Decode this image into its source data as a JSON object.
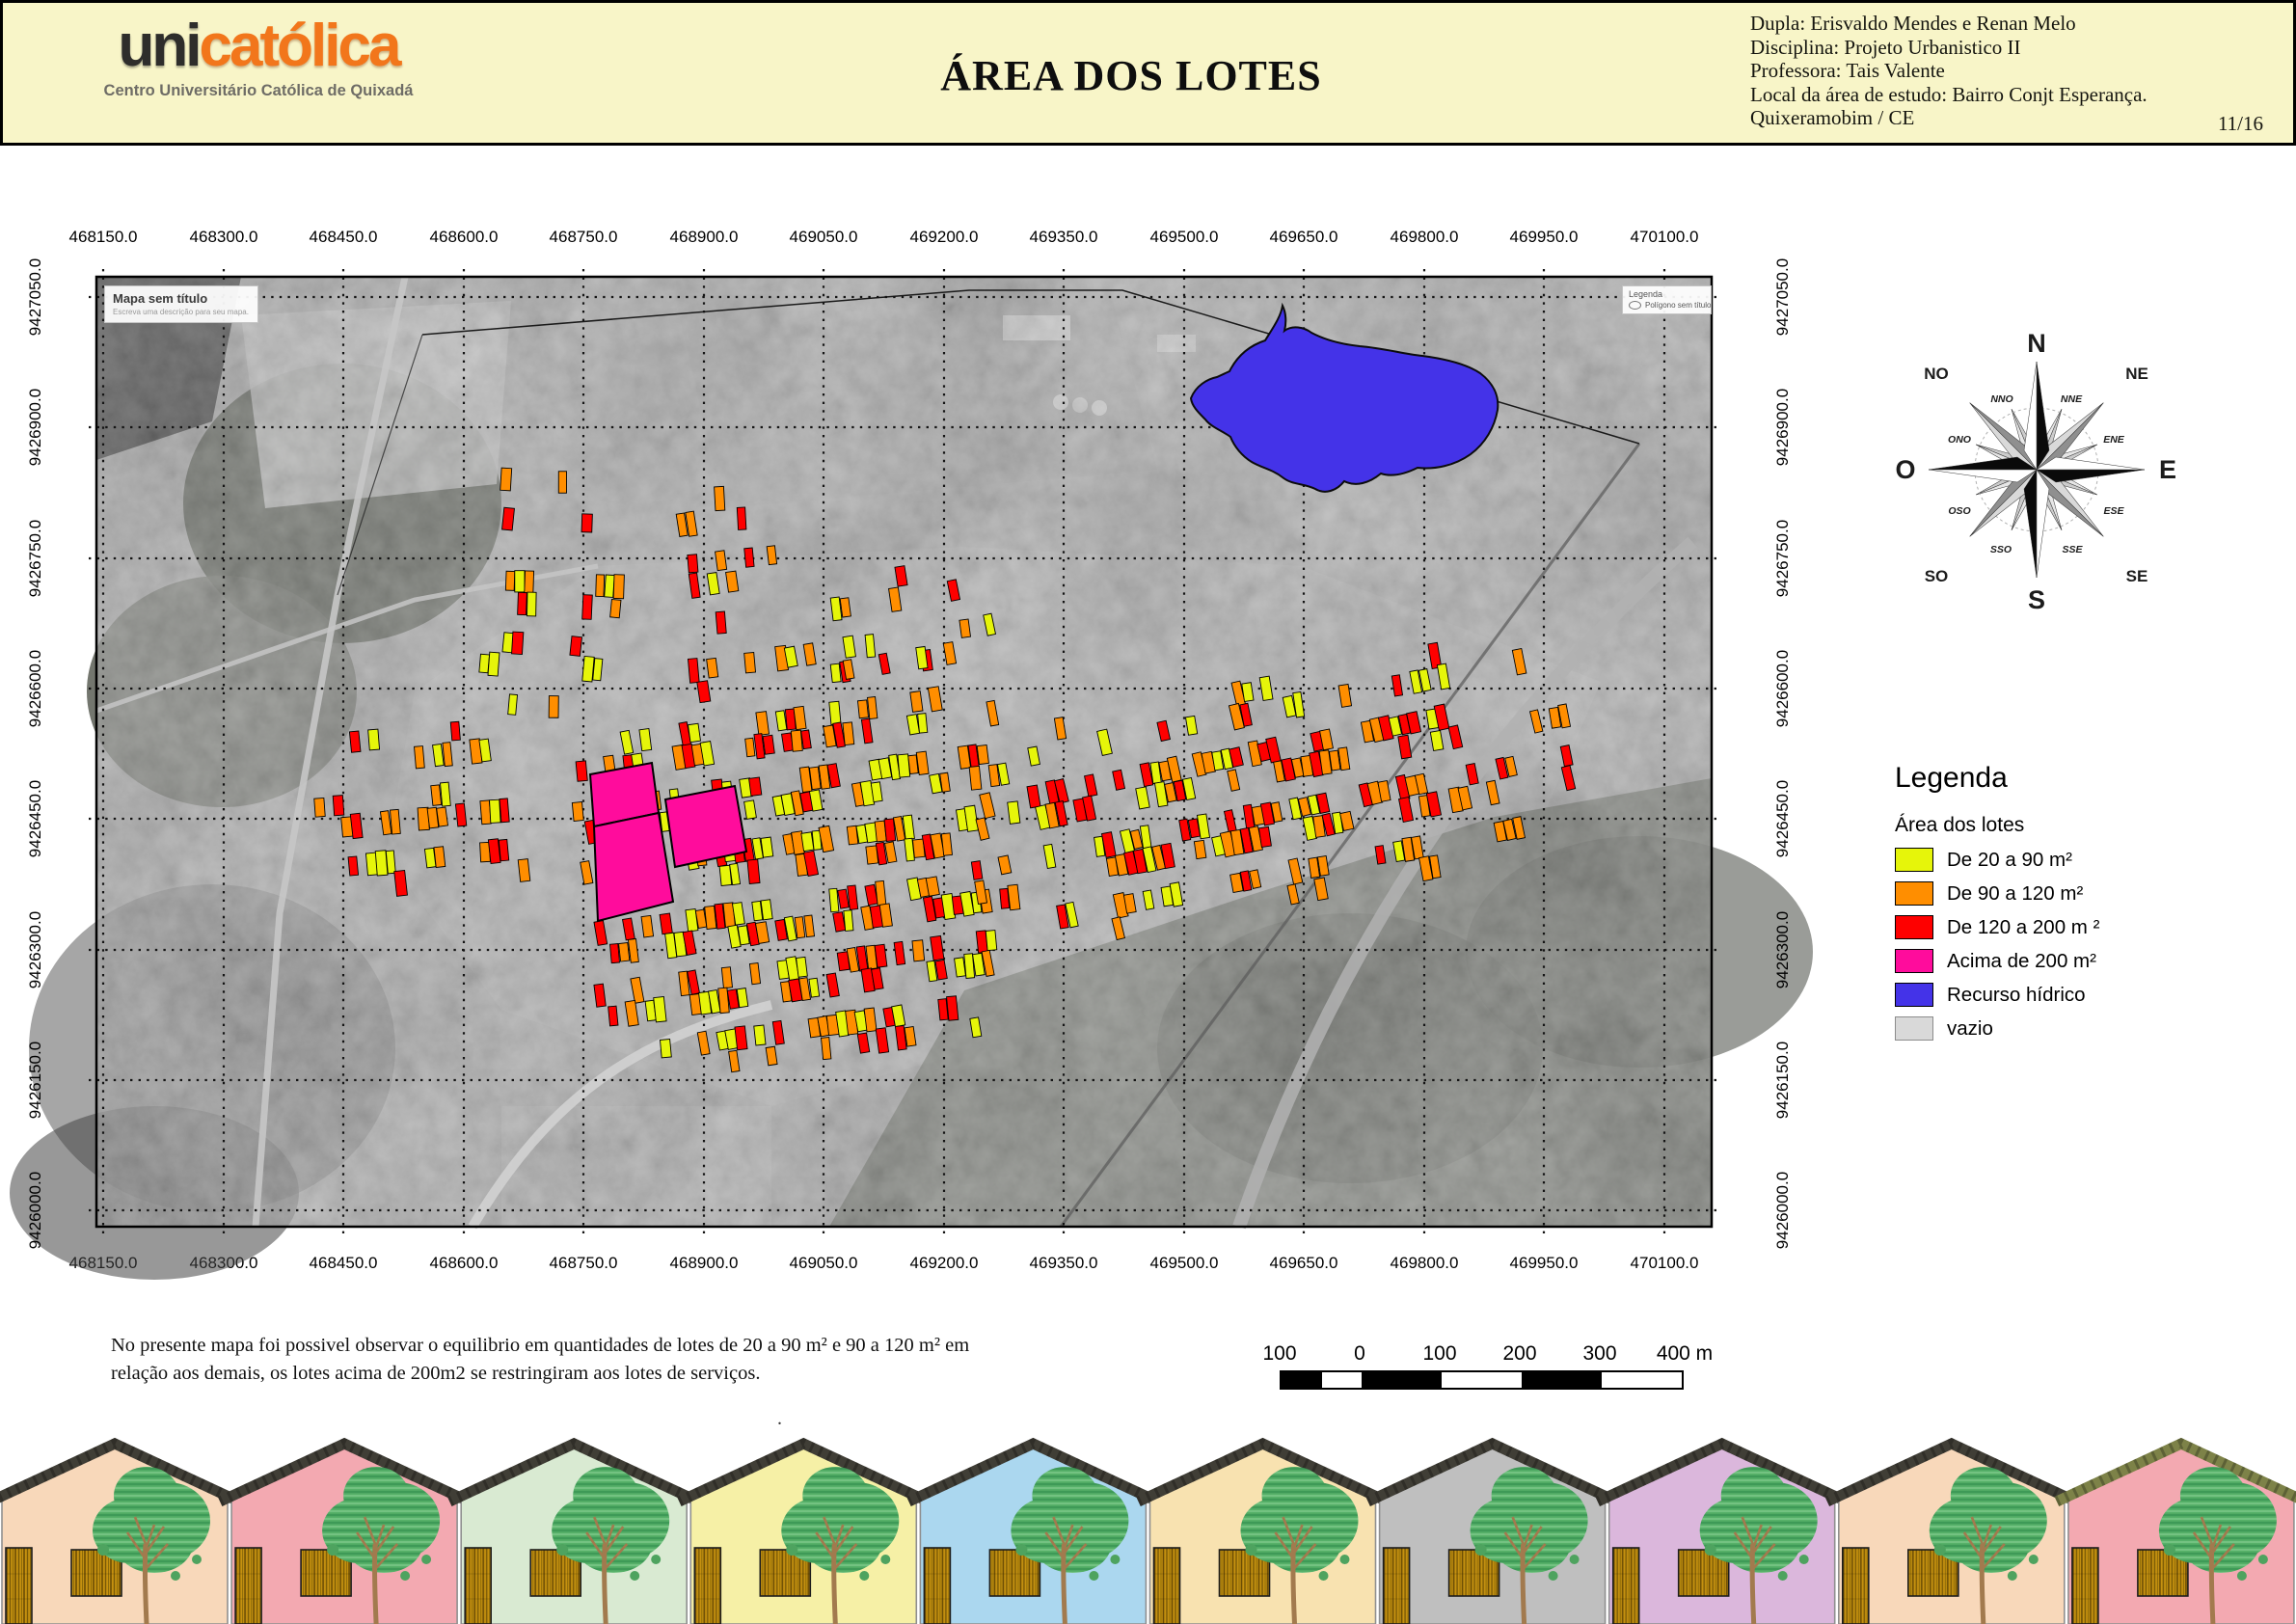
{
  "header": {
    "logo": {
      "part1": "uni",
      "part2": "católica",
      "subtitle": "Centro Universitário Católica de Quixadá"
    },
    "title": "ÁREA DOS LOTES",
    "info_lines": [
      "Dupla: Erisvaldo Mendes e Renan Melo",
      "Disciplina: Projeto Urbanistico II",
      "Professora: Tais Valente",
      "Local da área de estudo: Bairro Conjt Esperança.",
      "Quixeramobim / CE"
    ],
    "page_number": "11/16",
    "background_color": "#f8f5c8"
  },
  "map": {
    "x_ticks": [
      "468150.0",
      "468300.0",
      "468450.0",
      "468600.0",
      "468750.0",
      "468900.0",
      "469050.0",
      "469200.0",
      "469350.0",
      "469500.0",
      "469650.0",
      "469800.0",
      "469950.0",
      "470100.0"
    ],
    "y_ticks": [
      "9427050.0",
      "9426900.0",
      "9426750.0",
      "9426600.0",
      "9426450.0",
      "9426300.0",
      "9426150.0",
      "9426000.0"
    ],
    "overlay_boxes": {
      "untitled_map": {
        "title": "Mapa sem título",
        "subtitle": "Escreva uma descrição para seu mapa."
      },
      "mini_legend": {
        "title": "Legenda",
        "item": "Polígono sem título"
      }
    }
  },
  "compass": {
    "cardinals": [
      "N",
      "E",
      "S",
      "O"
    ],
    "intercardinals": [
      "NE",
      "SE",
      "SO",
      "NO"
    ],
    "secondary": [
      "NNE",
      "ENE",
      "ESE",
      "SSE",
      "SSO",
      "OSO",
      "ONO",
      "NNO"
    ]
  },
  "legend": {
    "title": "Legenda",
    "subtitle": "Área dos lotes",
    "items": [
      {
        "label": "De 20 a 90 m²",
        "color": "#e6f50a",
        "border": "#000000"
      },
      {
        "label": "De 90 a 120 m²",
        "color": "#ff8e00",
        "border": "#000000"
      },
      {
        "label": "De 120 a 200 m ²",
        "color": "#fe0000",
        "border": "#000000"
      },
      {
        "label": "Acima de 200  m²",
        "color": "#ff0c9c",
        "border": "#000000"
      },
      {
        "label": "Recurso hídrico",
        "color": "#4433e8",
        "border": "#000000"
      },
      {
        "label": "vazio",
        "color": "#d9d9d9",
        "border": "#8c8c8c"
      }
    ]
  },
  "note": {
    "line1": "No presente mapa foi possivel observar o equilibrio em quantidades de lotes de 20 a 90 m² e 90 a 120 m² em",
    "line2": "relação aos demais, os lotes acima de 200m2 se restringiram aos lotes de serviços.",
    "dot": "."
  },
  "scale_bar": {
    "labels": [
      "100",
      "0",
      "100",
      "200",
      "300",
      "400 m"
    ]
  },
  "houses": {
    "facades": [
      "#f8d8ba",
      "#f3a9b1",
      "#d9ead2",
      "#f6f0a6",
      "#abd7ef",
      "#f8e2b0",
      "#bfbfbf",
      "#dbb7dc",
      "#f8d8ba",
      "#f3a9b1"
    ],
    "roofs": [
      "#403e36",
      "#403e36",
      "#403e36",
      "#403e36",
      "#403e36",
      "#403e36",
      "#403e36",
      "#403e36",
      "#403e36",
      "#7d8248"
    ]
  }
}
